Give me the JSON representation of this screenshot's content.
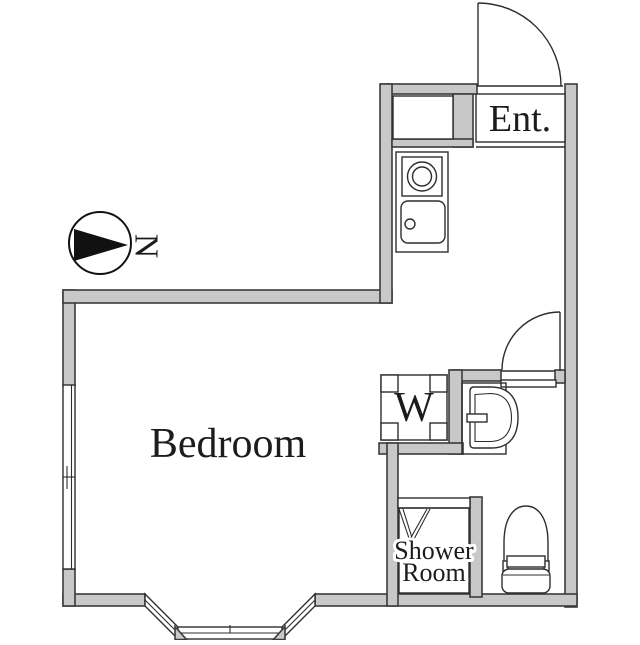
{
  "theme": {
    "wall_fill": "#c8c8c8",
    "wall_stroke": "#3b3b3b",
    "line_color": "#2d2d2d",
    "text_color": "#1c1c1c",
    "background": "#ffffff"
  },
  "plan": {
    "bedroom_label": "Bedroom",
    "entrance_label": "Ent.",
    "washer_label": "W",
    "shower_label_line1": "Shower",
    "shower_label_line2": "Room",
    "compass_label": "N"
  },
  "fixtures": {
    "kitchen": [
      "upper-cabinet",
      "single-burner-stove",
      "kitchen-sink"
    ],
    "utility": [
      "washing-machine"
    ],
    "bathroom": [
      "wash-basin",
      "toilet"
    ],
    "windows": [
      "left-sliding-window",
      "bay-window"
    ],
    "doors": [
      "entrance-door",
      "bathroom-door",
      "shower-bifold-door"
    ]
  }
}
